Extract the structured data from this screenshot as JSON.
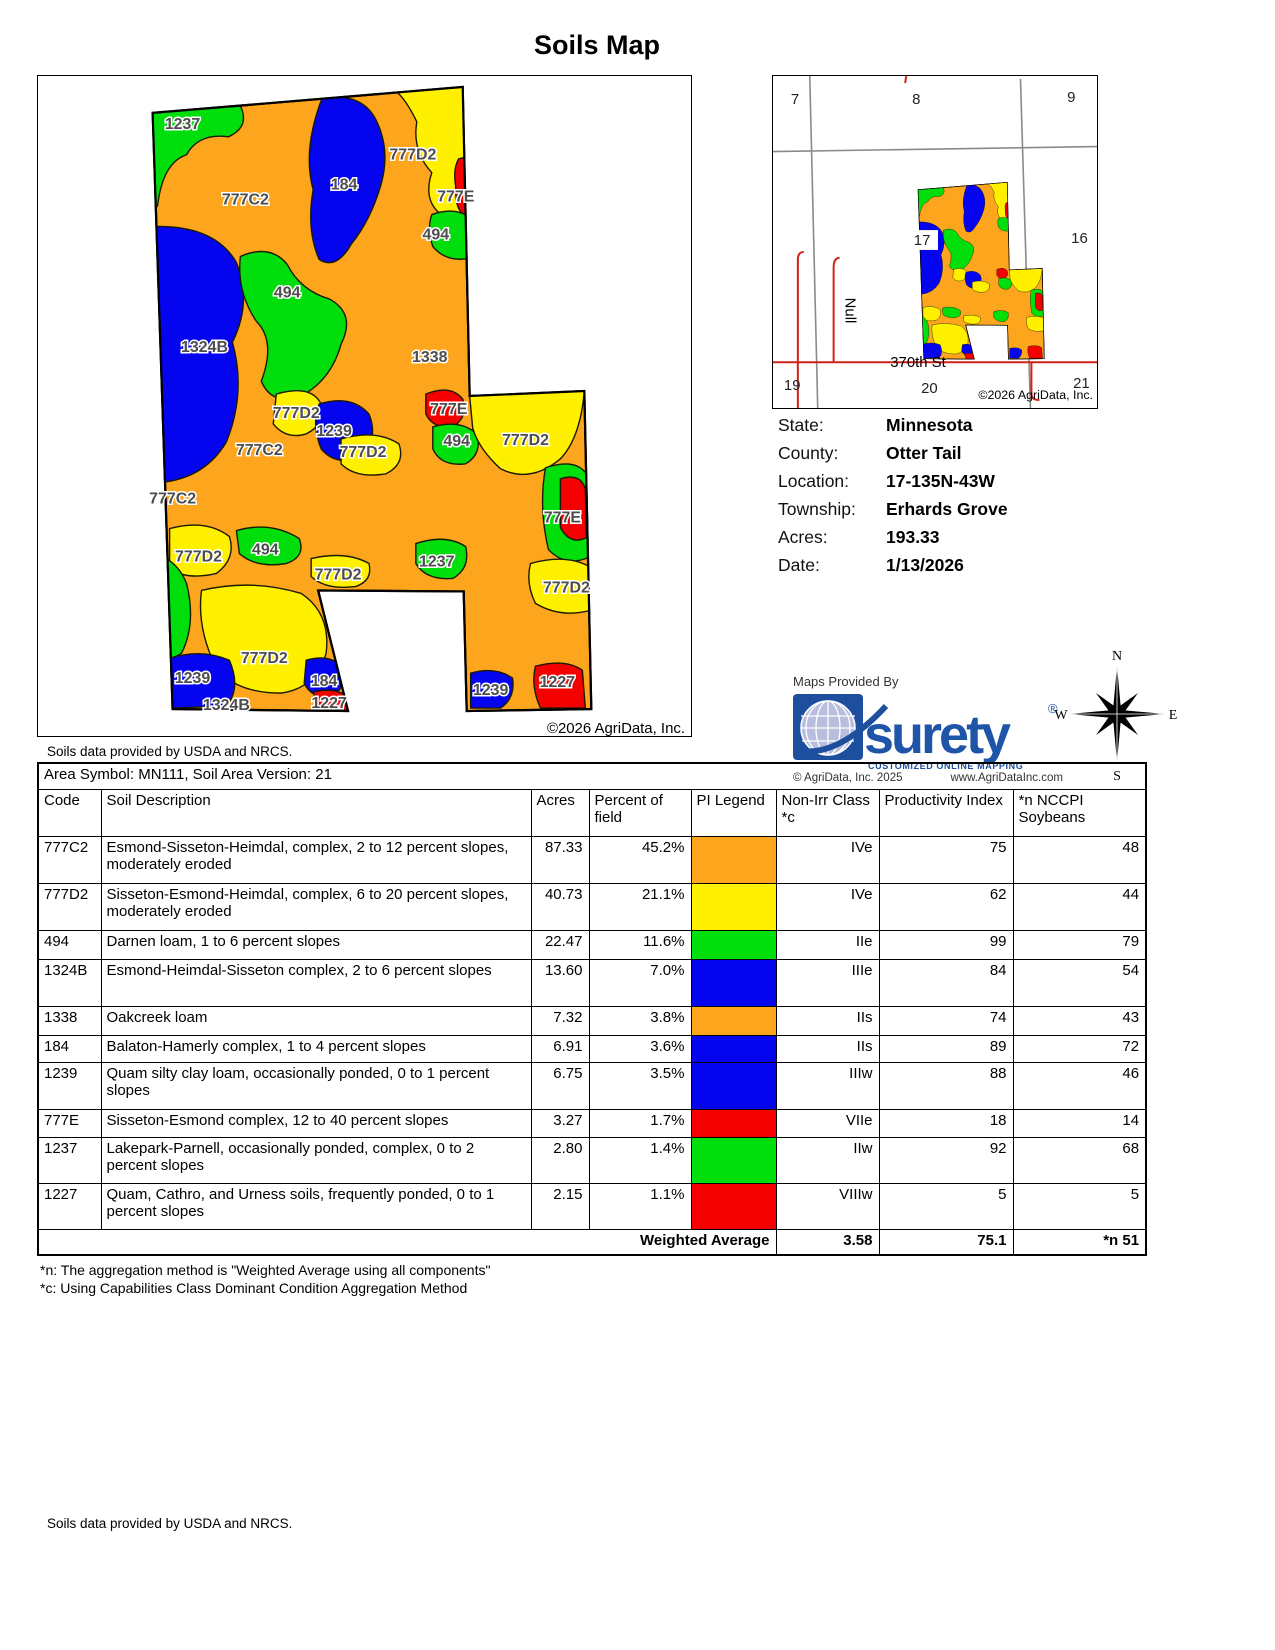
{
  "page": {
    "title": "Soils Map"
  },
  "colors": {
    "orange": "#FCA51D",
    "yellow": "#FFF000",
    "green": "#00DE0C",
    "blue": "#0404EF",
    "red": "#F40000"
  },
  "soil_map": {
    "copyright": "©2026 AgriData, Inc.",
    "provider_note": "Soils data provided by USDA and NRCS.",
    "labels": [
      {
        "t": "1237",
        "x": 182,
        "y": 128
      },
      {
        "t": "777C2",
        "x": 245,
        "y": 204
      },
      {
        "t": "184",
        "x": 344,
        "y": 189
      },
      {
        "t": "777D2",
        "x": 413,
        "y": 159
      },
      {
        "t": "777E",
        "x": 456,
        "y": 201
      },
      {
        "t": "494",
        "x": 436,
        "y": 239
      },
      {
        "t": "494",
        "x": 287,
        "y": 297
      },
      {
        "t": "1324B",
        "x": 204,
        "y": 352
      },
      {
        "t": "1338",
        "x": 430,
        "y": 362
      },
      {
        "t": "777D2",
        "x": 296,
        "y": 418
      },
      {
        "t": "1239",
        "x": 334,
        "y": 436
      },
      {
        "t": "777D2",
        "x": 363,
        "y": 457
      },
      {
        "t": "777E",
        "x": 449,
        "y": 414
      },
      {
        "t": "494",
        "x": 457,
        "y": 446
      },
      {
        "t": "777D2",
        "x": 526,
        "y": 445
      },
      {
        "t": "777C2",
        "x": 259,
        "y": 455
      },
      {
        "t": "777C2",
        "x": 172,
        "y": 504
      },
      {
        "t": "777E",
        "x": 563,
        "y": 523
      },
      {
        "t": "777D2",
        "x": 198,
        "y": 562
      },
      {
        "t": "494",
        "x": 265,
        "y": 555
      },
      {
        "t": "777D2",
        "x": 338,
        "y": 580
      },
      {
        "t": "1237",
        "x": 437,
        "y": 567
      },
      {
        "t": "777D2",
        "x": 567,
        "y": 593
      },
      {
        "t": "777D2",
        "x": 264,
        "y": 664
      },
      {
        "t": "1239",
        "x": 192,
        "y": 684
      },
      {
        "t": "184",
        "x": 324,
        "y": 687
      },
      {
        "t": "1227",
        "x": 329,
        "y": 709
      },
      {
        "t": "1324B",
        "x": 226,
        "y": 711
      },
      {
        "t": "1239",
        "x": 491,
        "y": 696
      },
      {
        "t": "1227",
        "x": 558,
        "y": 688
      }
    ]
  },
  "locator": {
    "sections": [
      {
        "n": "7",
        "x": 790,
        "y": 103
      },
      {
        "n": "8",
        "x": 912,
        "y": 103
      },
      {
        "n": "9",
        "x": 1068,
        "y": 101
      },
      {
        "n": "16",
        "x": 1072,
        "y": 243
      },
      {
        "n": "19",
        "x": 783,
        "y": 391
      },
      {
        "n": "20",
        "x": 921,
        "y": 394
      },
      {
        "n": "21",
        "x": 1074,
        "y": 389
      }
    ],
    "field_number": "17",
    "street": "370th St",
    "null_road": "Null",
    "copyright": "©2026 AgriData, Inc."
  },
  "info": {
    "rows": [
      {
        "label": "State:",
        "value": "Minnesota"
      },
      {
        "label": "County:",
        "value": "Otter Tail"
      },
      {
        "label": "Location:",
        "value": "17-135N-43W"
      },
      {
        "label": "Township:",
        "value": "Erhards Grove"
      },
      {
        "label": "Acres:",
        "value": "193.33"
      },
      {
        "label": "Date:",
        "value": "1/13/2026"
      }
    ]
  },
  "branding": {
    "provided_by": "Maps Provided By",
    "logo_text": "surety",
    "logo_registered": "®",
    "logo_tagline": "CUSTOMIZED ONLINE MAPPING",
    "copyright": "© AgriData, Inc. 2025",
    "website": "www.AgriDataInc.com"
  },
  "compass": {
    "n": "N",
    "s": "S",
    "e": "E",
    "w": "W"
  },
  "table": {
    "area_symbol": "Area Symbol: MN111, Soil Area Version: 21",
    "columns": [
      "Code",
      "Soil Description",
      "Acres",
      "Percent of field",
      "PI Legend",
      "Non-Irr Class *c",
      "Productivity Index",
      "*n NCCPI Soybeans"
    ],
    "rows": [
      {
        "code": "777C2",
        "description": "Esmond-Sisseton-Heimdal, complex, 2 to 12 percent slopes, moderately eroded",
        "acres": "87.33",
        "percent": "45.2%",
        "color": "orange",
        "non_irr": "IVe",
        "pi": "75",
        "nccpi": "48",
        "h": 47
      },
      {
        "code": "777D2",
        "description": "Sisseton-Esmond-Heimdal, complex, 6 to 20 percent slopes, moderately eroded",
        "acres": "40.73",
        "percent": "21.1%",
        "color": "yellow",
        "non_irr": "IVe",
        "pi": "62",
        "nccpi": "44",
        "h": 47
      },
      {
        "code": "494",
        "description": "Darnen loam, 1 to 6 percent slopes",
        "acres": "22.47",
        "percent": "11.6%",
        "color": "green",
        "non_irr": "IIe",
        "pi": "99",
        "nccpi": "79",
        "h": 29
      },
      {
        "code": "1324B",
        "description": "Esmond-Heimdal-Sisseton complex, 2 to 6 percent slopes",
        "acres": "13.60",
        "percent": "7.0%",
        "color": "blue",
        "non_irr": "IIIe",
        "pi": "84",
        "nccpi": "54",
        "h": 47
      },
      {
        "code": "1338",
        "description": "Oakcreek loam",
        "acres": "7.32",
        "percent": "3.8%",
        "color": "orange",
        "non_irr": "IIs",
        "pi": "74",
        "nccpi": "43",
        "h": 29
      },
      {
        "code": "184",
        "description": "Balaton-Hamerly complex, 1 to 4 percent slopes",
        "acres": "6.91",
        "percent": "3.6%",
        "color": "blue",
        "non_irr": "IIs",
        "pi": "89",
        "nccpi": "72",
        "h": 27
      },
      {
        "code": "1239",
        "description": "Quam silty clay loam, occasionally ponded, 0 to 1 percent slopes",
        "acres": "6.75",
        "percent": "3.5%",
        "color": "blue",
        "non_irr": "IIIw",
        "pi": "88",
        "nccpi": "46",
        "h": 47
      },
      {
        "code": "777E",
        "description": "Sisseton-Esmond complex, 12 to 40 percent slopes",
        "acres": "3.27",
        "percent": "1.7%",
        "color": "red",
        "non_irr": "VIIe",
        "pi": "18",
        "nccpi": "14",
        "h": 28
      },
      {
        "code": "1237",
        "description": "Lakepark-Parnell, occasionally ponded, complex, 0 to 2 percent slopes",
        "acres": "2.80",
        "percent": "1.4%",
        "color": "green",
        "non_irr": "IIw",
        "pi": "92",
        "nccpi": "68",
        "h": 46
      },
      {
        "code": "1227",
        "description": "Quam, Cathro, and Urness soils, frequently ponded, 0 to 1 percent slopes",
        "acres": "2.15",
        "percent": "1.1%",
        "color": "red",
        "non_irr": "VIIIw",
        "pi": "5",
        "nccpi": "5",
        "h": 46
      }
    ],
    "weighted": {
      "label": "Weighted Average",
      "non_irr": "3.58",
      "pi": "75.1",
      "nccpi": "*n 51"
    },
    "footnotes": [
      "*n: The aggregation method is \"Weighted Average using all components\"",
      "*c: Using Capabilities Class Dominant Condition Aggregation Method"
    ]
  },
  "footer": {
    "note": "Soils data provided by USDA and NRCS."
  }
}
